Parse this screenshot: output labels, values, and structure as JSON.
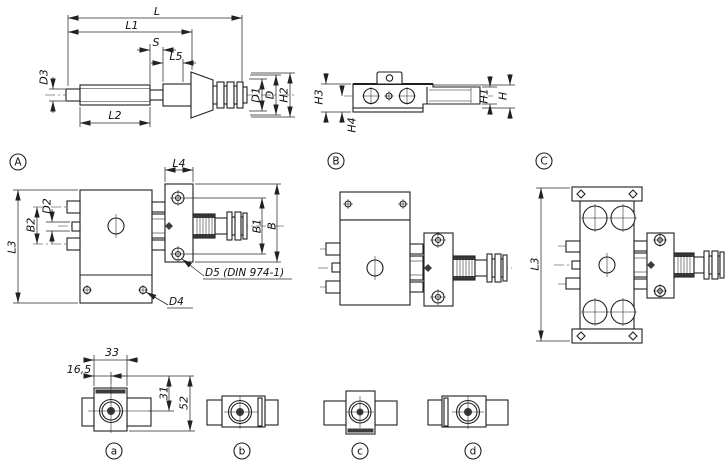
{
  "drawing": {
    "type": "technical-dimension-drawing",
    "background": "#ffffff",
    "colors": {
      "line": "#1f1f1f",
      "dimension": "#2a2a2a",
      "dark_fill": "#3c3c3c"
    },
    "views": {
      "shaft_side": {
        "description": "threaded spindle with coupling, side view",
        "dims": {
          "L": "L",
          "L1": "L1",
          "S": "S",
          "L5": "L5",
          "D3": "D3",
          "L2": "L2",
          "D1": "D1",
          "D": "D",
          "H2": "H2"
        }
      },
      "carriage_side": {
        "description": "carriage / slide side view",
        "dims": {
          "H3": "H3",
          "H4": "H4",
          "H1": "H1",
          "H": "H"
        }
      },
      "variant_a_top": {
        "marker": "A",
        "dims": {
          "L4": "L4",
          "D2": "D2",
          "B2": "B2",
          "L3": "L3",
          "B1": "B1",
          "B": "B",
          "D5": "D5 (DIN 974-1)",
          "D4": "D4"
        }
      },
      "variant_b_top": {
        "marker": "B"
      },
      "variant_c_top": {
        "marker": "C",
        "dims": {
          "L3": "L3"
        }
      },
      "end_view_a": {
        "marker": "a",
        "dims": {
          "width": "33",
          "half_width": "16,5",
          "upper_height": "31",
          "total_height": "52"
        }
      },
      "end_view_b": {
        "marker": "b"
      },
      "end_view_c": {
        "marker": "c"
      },
      "end_view_d": {
        "marker": "d"
      }
    }
  }
}
